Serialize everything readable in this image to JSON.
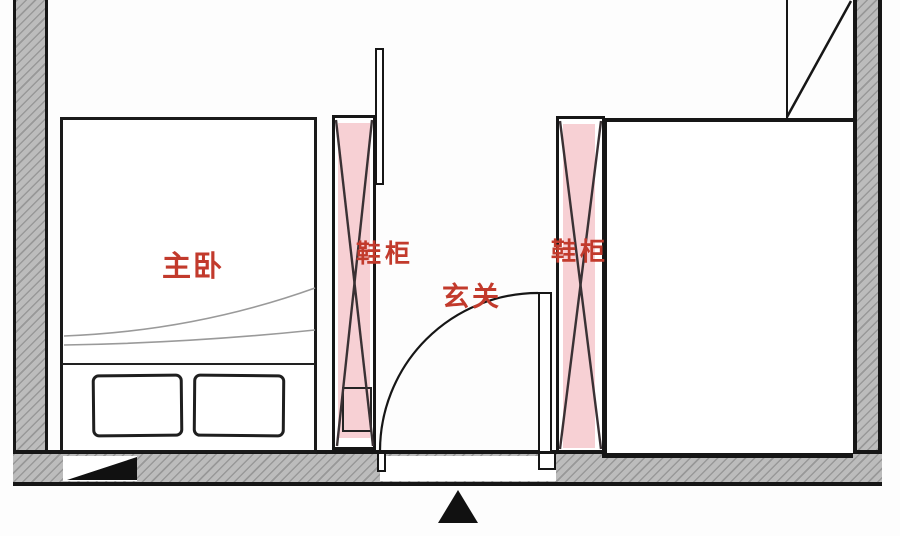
{
  "diagram": {
    "type": "apartment-floor-plan",
    "labels": {
      "master_bedroom": "主卧",
      "shoe_cabinet_left": "鞋柜",
      "shoe_cabinet_right": "鞋柜",
      "entrance": "玄关"
    },
    "highlights": [
      {
        "target": "shoe-cabinet-left",
        "style": "pink-strip-with-x-cross"
      },
      {
        "target": "shoe-cabinet-right",
        "style": "pink-strip-with-x-cross"
      }
    ],
    "symbols": [
      {
        "name": "entrance-arrow",
        "shape": "black-triangle-up"
      },
      {
        "name": "wall-break-triangle",
        "shape": "black-right-triangle"
      },
      {
        "name": "door-swing-arc",
        "radius_px": 158
      },
      {
        "name": "corner-cabinet-diagonal",
        "location": "top-right"
      }
    ],
    "colors": {
      "label_red": "#c23a2c",
      "highlight_pink": "#f7d0d4",
      "wall_fill_gray": "#bcbcbc",
      "wall_hatch_gray": "#989898",
      "line_black": "#161616",
      "blanket_curve_gray": "#9a9a9a"
    }
  }
}
